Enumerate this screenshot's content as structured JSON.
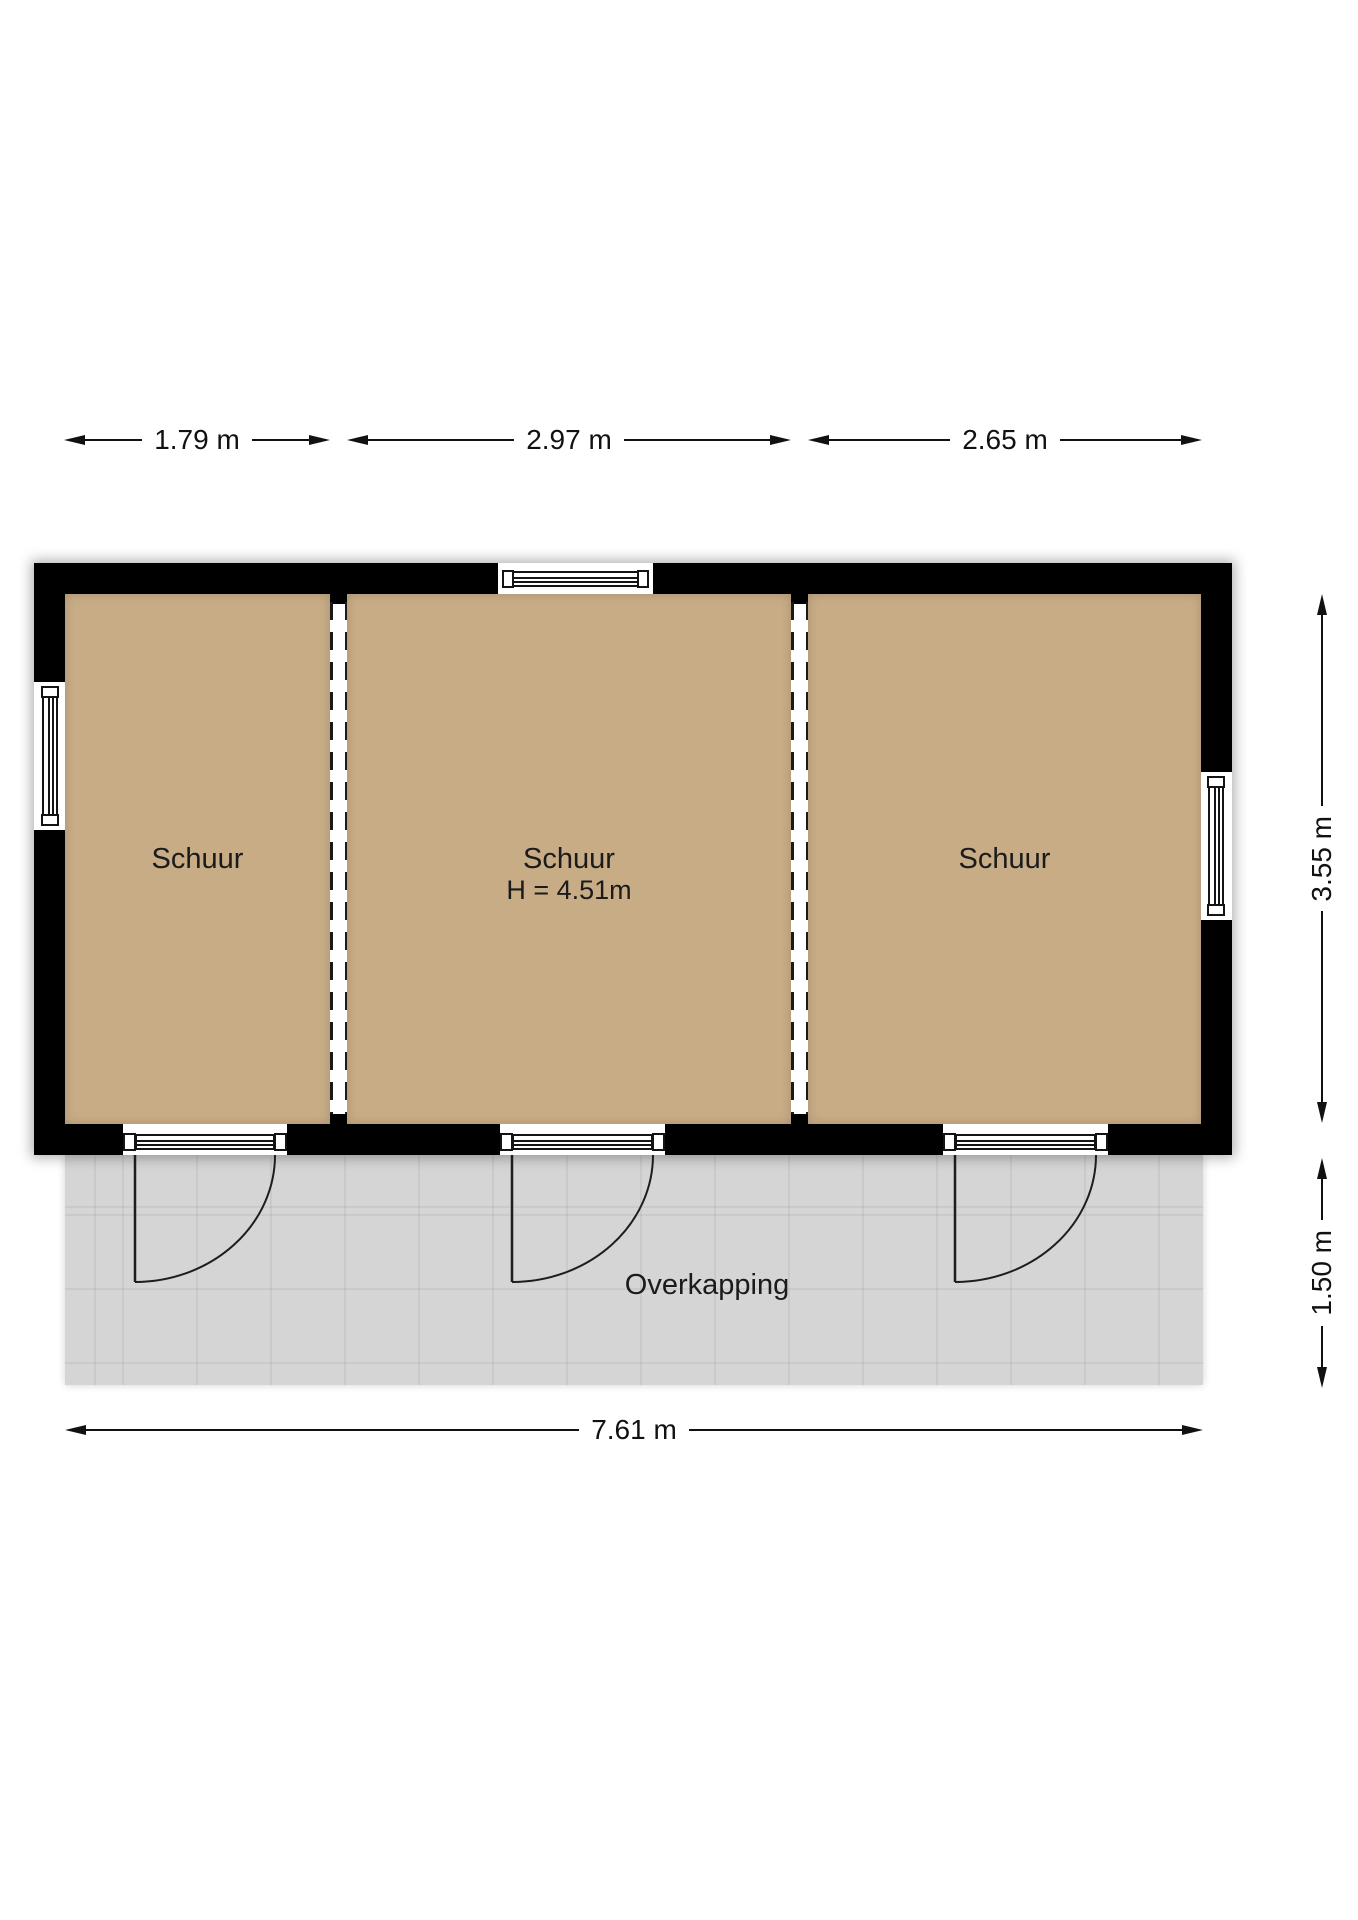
{
  "plan": {
    "building": {
      "rooms": [
        {
          "label": "Schuur"
        },
        {
          "label": "Schuur",
          "height_label": "H = 4.51m"
        },
        {
          "label": "Schuur"
        }
      ]
    },
    "canopy": {
      "label": "Overkapping"
    },
    "dimensions": {
      "top": [
        {
          "label": "1.79 m"
        },
        {
          "label": "2.97 m"
        },
        {
          "label": "2.65 m"
        }
      ],
      "right": [
        {
          "label": "3.55 m"
        },
        {
          "label": "1.50 m"
        }
      ],
      "bottom": [
        {
          "label": "7.61 m"
        }
      ]
    },
    "colors": {
      "wall": "#000000",
      "floor": "#C7AC85",
      "canopy": "#D5D5D5",
      "line": "#111111"
    }
  }
}
